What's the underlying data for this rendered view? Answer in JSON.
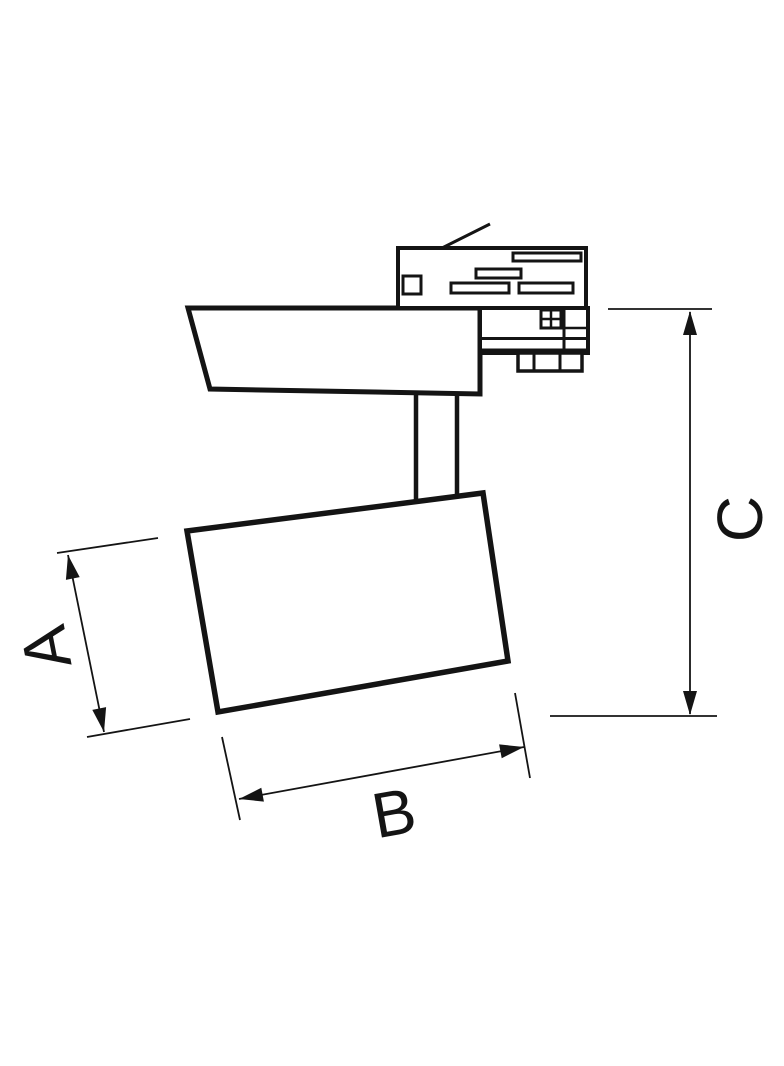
{
  "canvas": {
    "background": "#ffffff",
    "ink": "#141414"
  },
  "diagram": {
    "dimension_labels": {
      "a": "A",
      "b": "B",
      "c": "C"
    }
  }
}
